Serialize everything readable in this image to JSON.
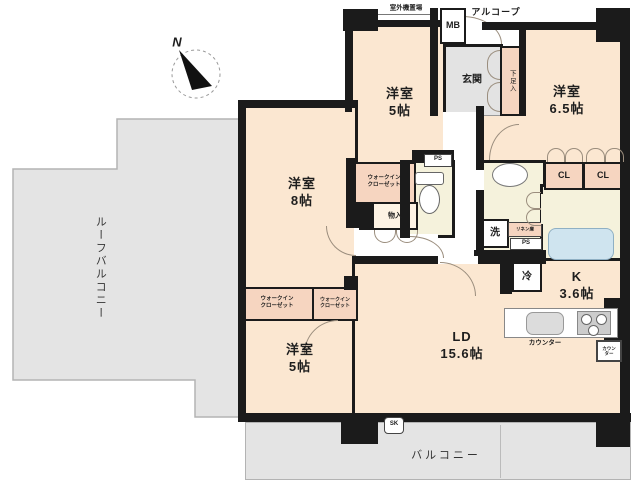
{
  "plan": {
    "compass_n": "N",
    "top_area": {
      "outdoor_unit": "室外機置場",
      "meter_box": "MB",
      "alcove": "アルコープ"
    },
    "entrance": {
      "genkan": "玄関",
      "shoe_cabinet": "下足入"
    },
    "rooms": {
      "bedroom_top": "洋室\n5帖",
      "bedroom_right": "洋室\n6.5帖",
      "bedroom_left": "洋室\n8帖",
      "bedroom_bottom": "洋室\n5帖",
      "living_dining": "LD\n15.6帖",
      "kitchen": "K\n3.6帖"
    },
    "storage": {
      "wic_top": "ウォークイン\nクローゼット",
      "wic_mid_left": "ウォークイン\nクローゼット",
      "wic_mid_right": "ウォークイン\nクローゼット",
      "closet_left": "CL",
      "closet_right": "CL",
      "storage_box": "物入",
      "linen": "リネン庫"
    },
    "fixtures": {
      "washer": "洗",
      "fridge": "冷",
      "pipe_space_wc": "PS",
      "pipe_space_wash": "PS",
      "counter": "カウンター",
      "counter_side": "カウン\nター",
      "slop_sink": "SK"
    },
    "outdoor": {
      "roof_balcony": "ルーフバルコニー",
      "balcony": "バルコニー"
    }
  }
}
